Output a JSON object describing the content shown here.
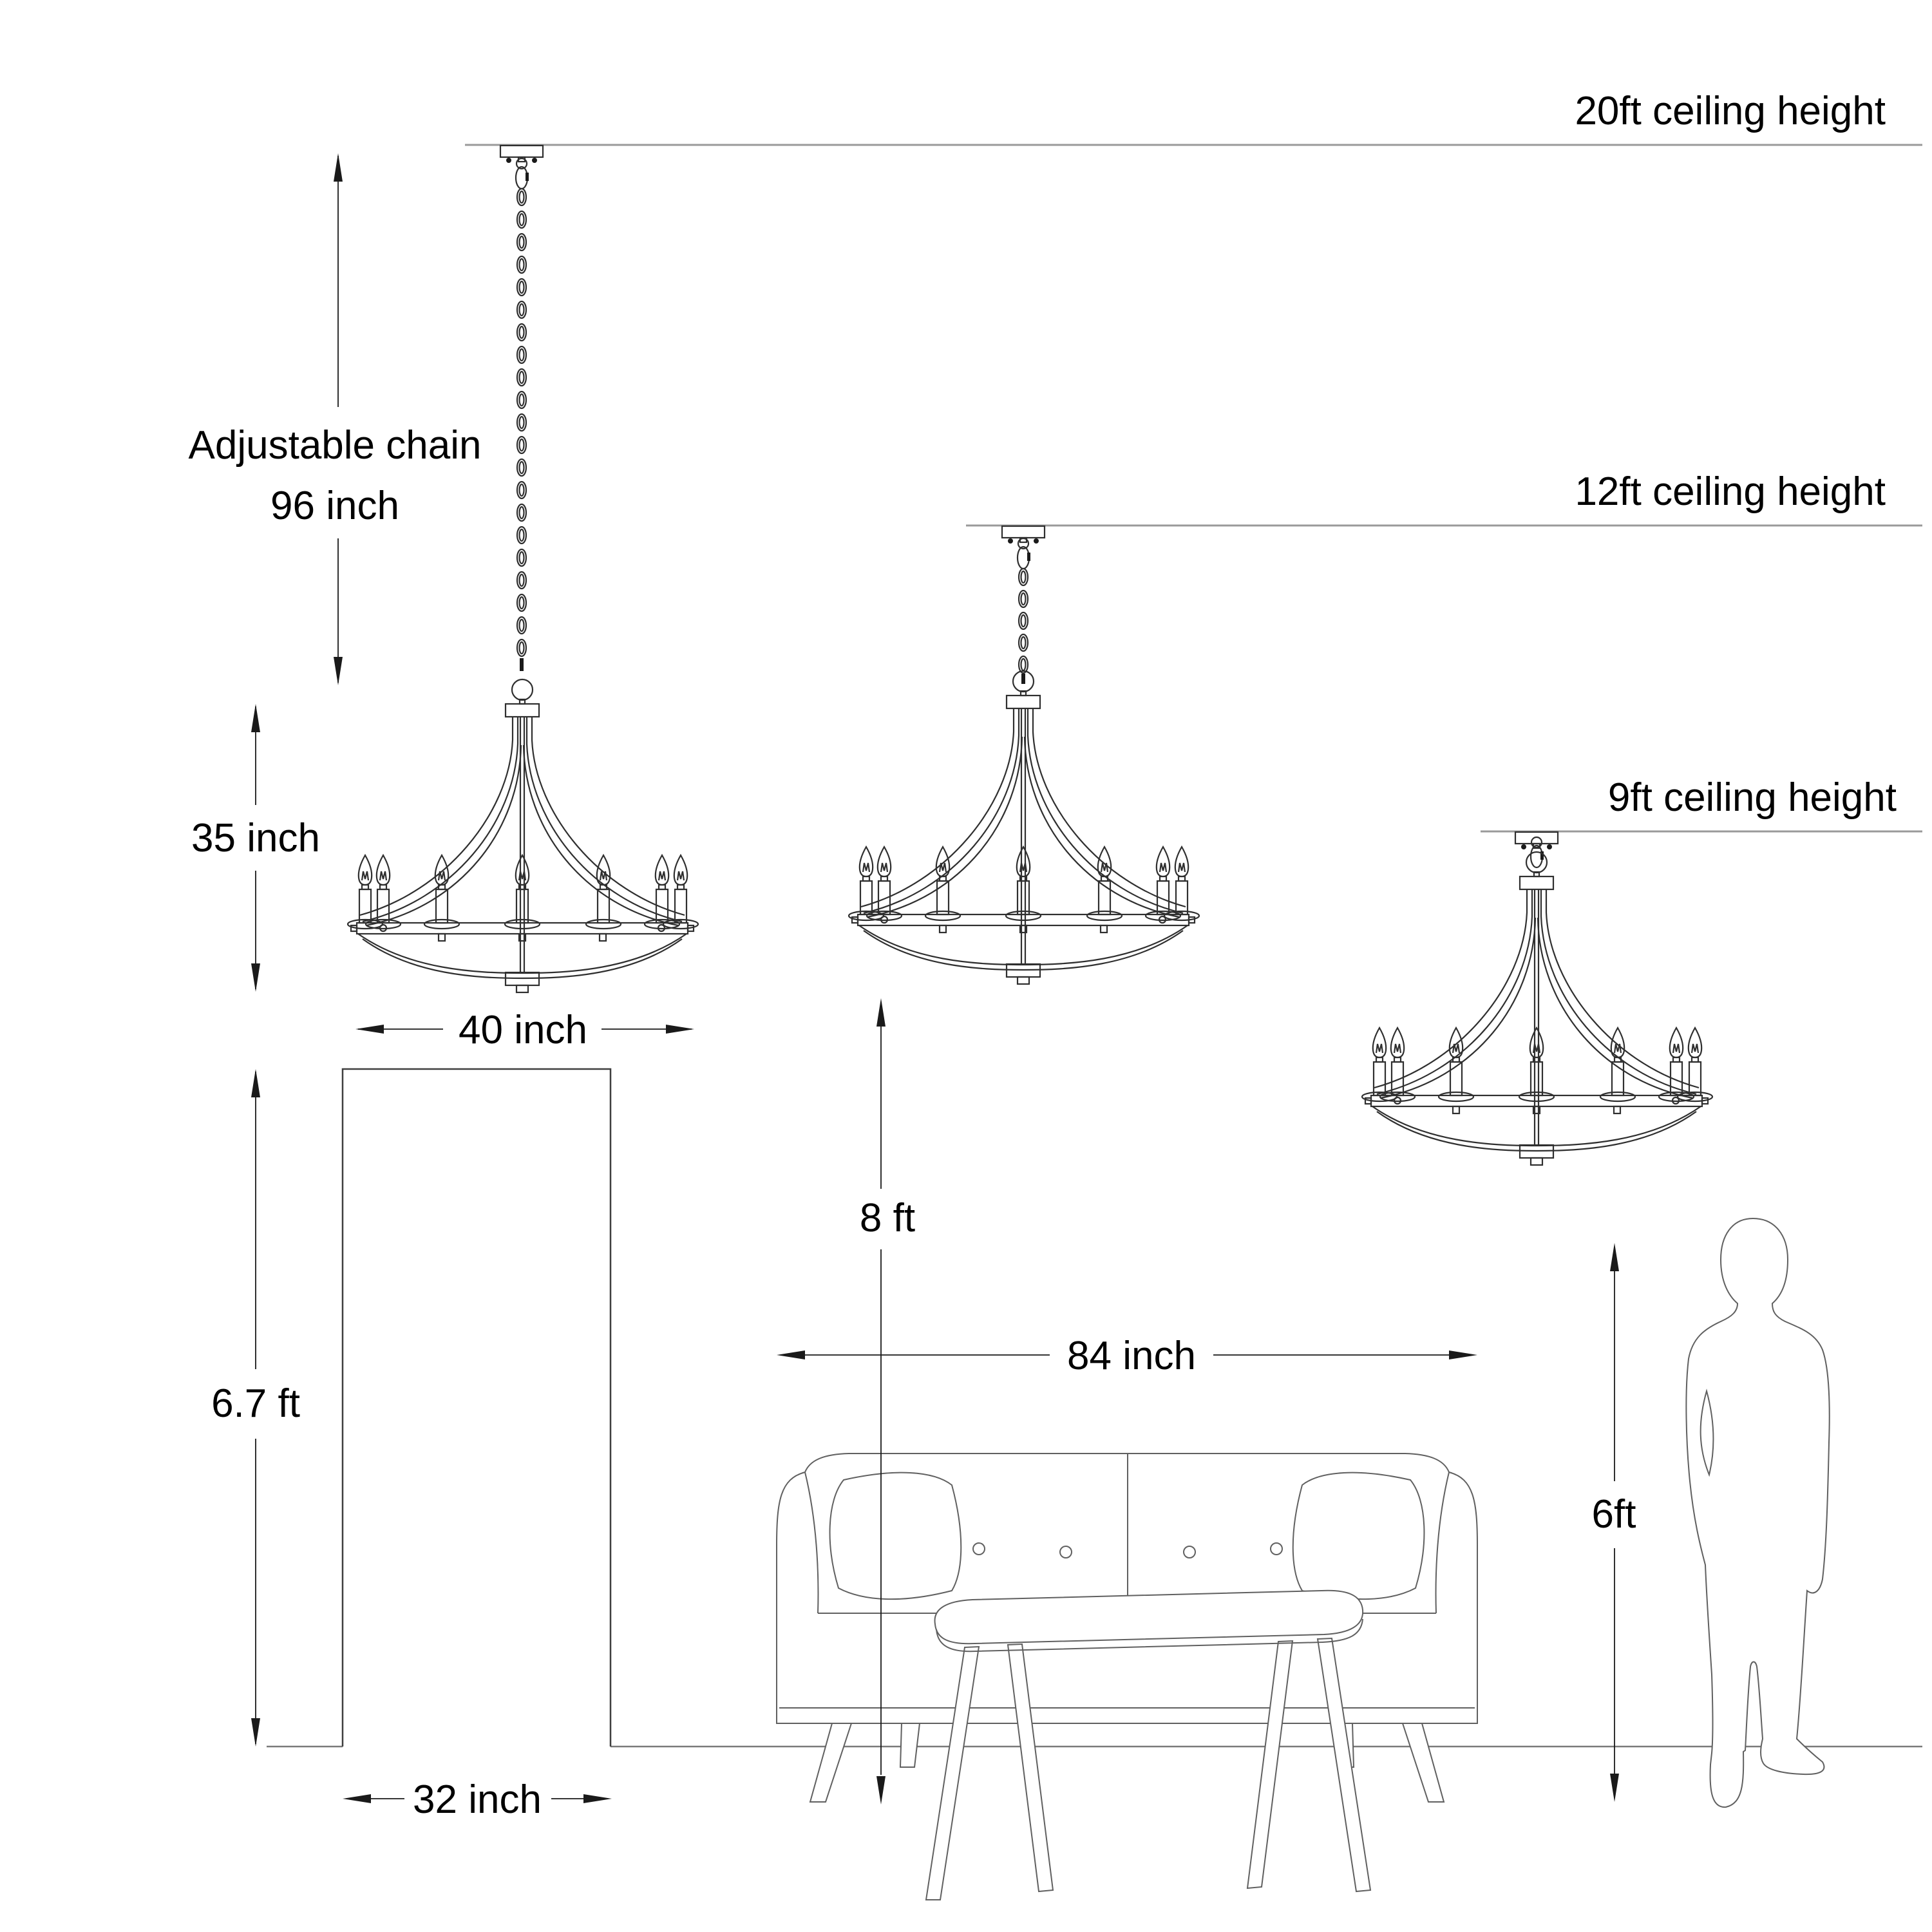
{
  "diagram_title": "Chandelier mounting-height diagram",
  "labels": {
    "ceiling_20": "20ft ceiling height",
    "ceiling_12": "12ft ceiling height",
    "ceiling_9": "9ft ceiling height",
    "chain_line1": "Adjustable chain",
    "chain_line2": "96 inch",
    "fixture_height": "35 inch",
    "fixture_width": "40 inch",
    "door_height": "6.7 ft",
    "door_width": "32 inch",
    "hang_clearance": "8 ft",
    "sofa_width": "84 inch",
    "person_height": "6ft"
  },
  "fixture": {
    "type": "candle chandelier",
    "visible_candles_per_fixture": 7,
    "fixtures_shown": 3,
    "chain_length": "96 inch",
    "body_height": "35 inch",
    "body_width": "40 inch"
  },
  "scene": {
    "ceiling_options": [
      "20ft",
      "12ft",
      "9ft"
    ],
    "door": {
      "height": "6.7 ft",
      "width": "32 inch"
    },
    "sofa_width": "84 inch",
    "hanging_clearance_above_floor": "8 ft",
    "person_height": "6ft"
  },
  "colors": {
    "background": "#ffffff",
    "line_art": "#2f2f2f",
    "ceiling_line": "#9a9a9a",
    "floor_line": "#7a7a7a",
    "text": "#000000"
  }
}
